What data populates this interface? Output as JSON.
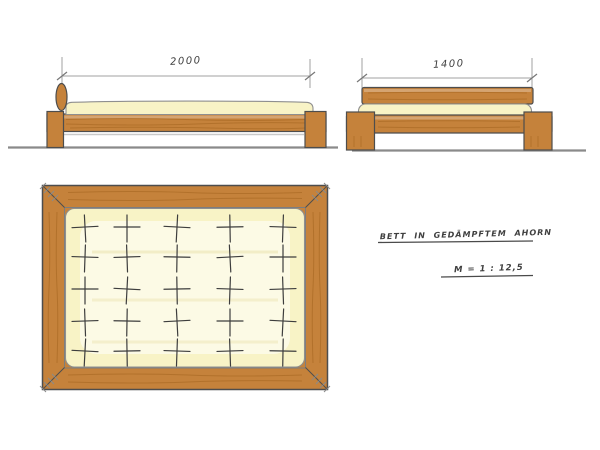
{
  "drawing": {
    "title": "BETT IN GEDÄMPFTEM AHORN",
    "scale_label": "M = 1 : 12,5",
    "views": {
      "side": {
        "dimension_label": "2000"
      },
      "front": {
        "dimension_label": "1400"
      },
      "top": {
        "tufting_rows": 5,
        "tufting_cols": 5
      }
    }
  },
  "colors": {
    "wood": "#c5823b",
    "wood_dark": "#a2641f",
    "mattress": "#f8f3c6",
    "outline": "#4d4d4d",
    "ground_line": "#8a8a8a",
    "dimension_line": "#a0a0a0",
    "ink": "#3f3f3f",
    "background": "#ffffff"
  }
}
